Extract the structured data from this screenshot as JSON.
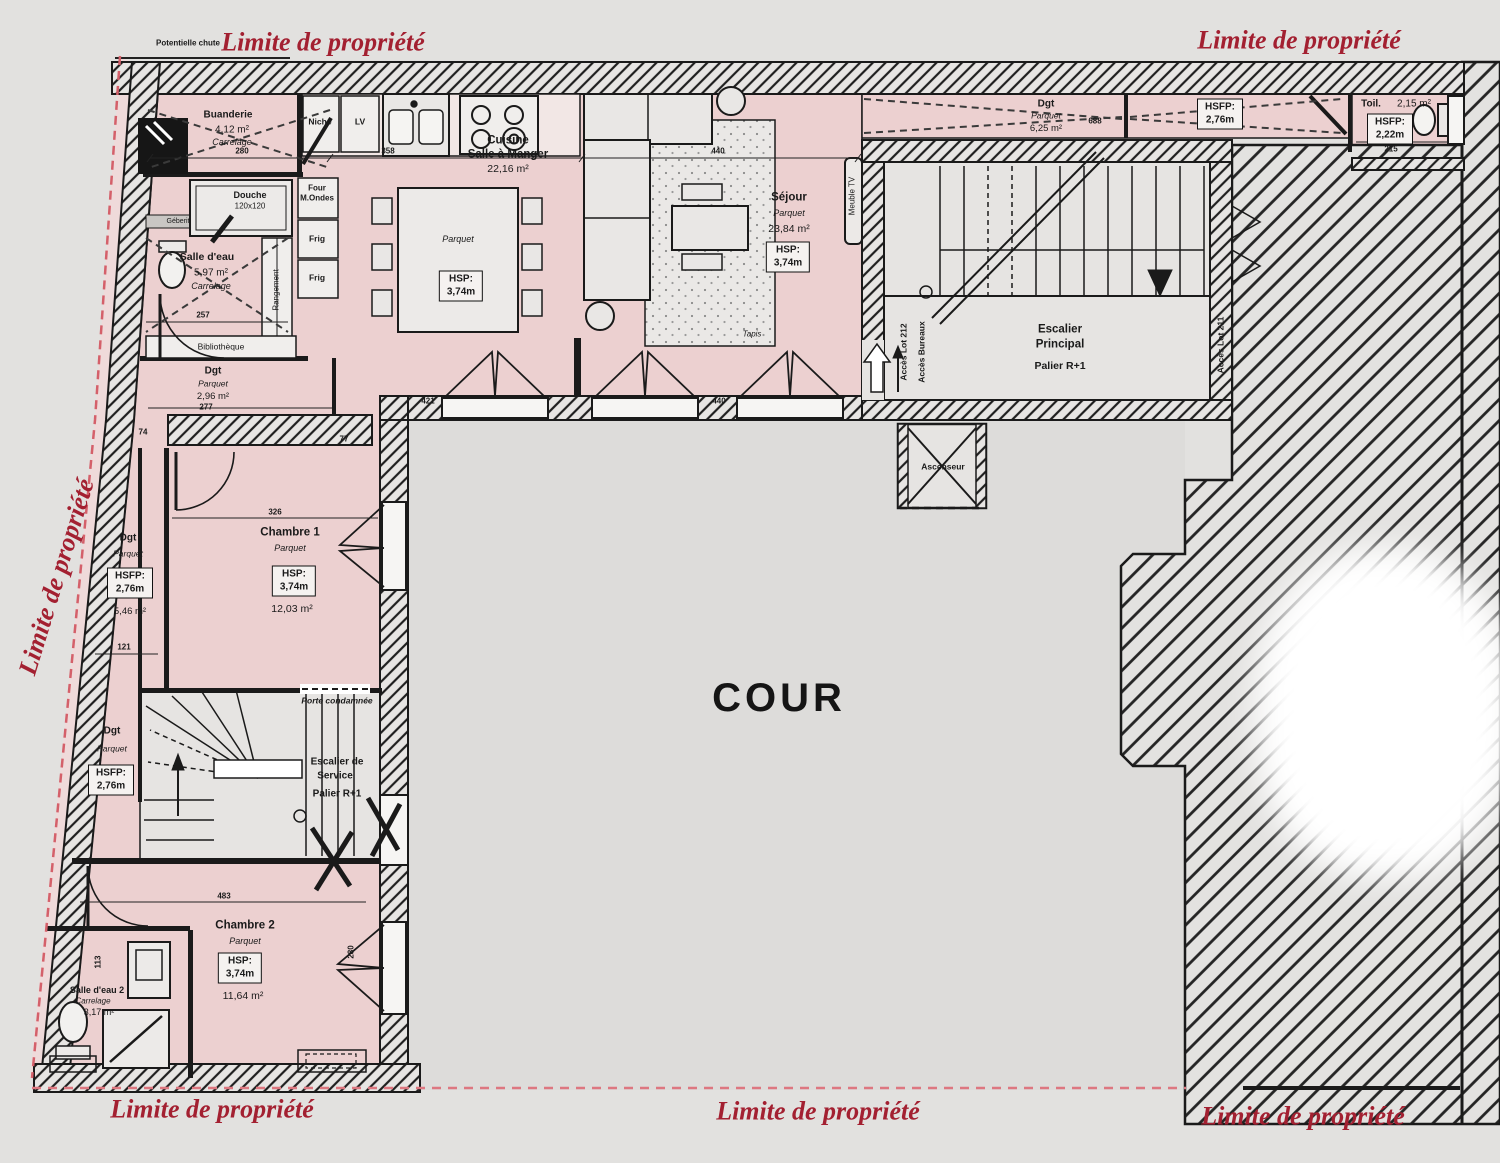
{
  "boundary": {
    "label": "Limite de propriété",
    "potential_fall": "Potentielle chute"
  },
  "cour": {
    "name": "COUR"
  },
  "rooms": {
    "buanderie": {
      "name": "Buanderie",
      "area": "4,12 m²",
      "floor": "Carrelage"
    },
    "salle_eau": {
      "name": "Salle d'eau",
      "area": "5,97 m²",
      "floor": "Carrelage",
      "geberit": "Géberit",
      "douche": "Douche",
      "douche_dim": "120x120",
      "rangement": "Rangement",
      "bibliotheque": "Bibliothèque"
    },
    "cuisine": {
      "name_line1": "Cuisine",
      "name_line2": "Salle à Manger",
      "area": "22,16 m²",
      "floor": "Parquet",
      "hsp_label": "HSP:",
      "hsp_value": "3,74m",
      "niche": "Niche",
      "lv": "LV",
      "four_line1": "Four",
      "four_line2": "M.Ondes",
      "frigo": "Frig",
      "frigo2": "Frig"
    },
    "sejour": {
      "name": "Séjour",
      "floor": "Parquet",
      "area": "23,84 m²",
      "hsp_label": "HSP:",
      "hsp_value": "3,74m",
      "tapis": "Tapis",
      "meuble_tv": "Meuble TV"
    },
    "dgt_nord": {
      "name": "Dgt",
      "floor": "Parquet",
      "area": "6,25 m²",
      "hsfp_label": "HSFP:",
      "hsfp_value": "2,76m"
    },
    "toilettes": {
      "name": "Toil.",
      "area": "2,15 m²",
      "hsfp_label": "HSFP:",
      "hsfp_value": "2,22m"
    },
    "escalier_principal": {
      "line1": "Escalier",
      "line2": "Principal",
      "line3": "Palier R+1",
      "acces_gauche_1": "Accès Lot 212",
      "acces_gauche_2": "Accès Bureaux",
      "acces_droite": "Accès Lot 211"
    },
    "ascenseur": {
      "name": "Ascenseur"
    },
    "dgt_entree": {
      "name": "Dgt",
      "floor": "Parquet",
      "area": "2,96 m²"
    },
    "dgt_ouest": {
      "name": "Dgt",
      "floor": "Parquet",
      "area": "5,46 m²",
      "hsfp_label": "HSFP:",
      "hsfp_value": "2,76m"
    },
    "chambre1": {
      "name": "Chambre 1",
      "floor": "Parquet",
      "area": "12,03 m²",
      "hsp_label": "HSP:",
      "hsp_value": "3,74m"
    },
    "dgt_sud": {
      "name": "Dgt",
      "floor": "Parquet",
      "hsfp_label": "HSFP:",
      "hsfp_value": "2,76m"
    },
    "escalier_service": {
      "line1": "Escalier de",
      "line2": "Service",
      "line3": "Palier R+1",
      "porte": "Porte condamnée"
    },
    "chambre2": {
      "name": "Chambre 2",
      "floor": "Parquet",
      "area": "11,64 m²",
      "hsp_label": "HSP:",
      "hsp_value": "3,74m"
    },
    "salle_eau2": {
      "name": "Salle d'eau 2",
      "floor": "Carrelage",
      "area": "3,17 m²"
    }
  },
  "dimensions": {
    "d280": "280",
    "d257": "257",
    "d277": "277",
    "d358": "358",
    "d440": "440",
    "d421": "421",
    "d326": "326",
    "d121": "121",
    "d74": "74",
    "d77": "77",
    "d483": "483",
    "d215": "215",
    "d688": "688",
    "d113": "113",
    "d280b": "280",
    "d440b": "440"
  },
  "colors": {
    "room_pink": "#ecd0d0",
    "boundary_red": "#a32031",
    "dash_red": "#d4606a",
    "wall_black": "#1a1a1a"
  }
}
